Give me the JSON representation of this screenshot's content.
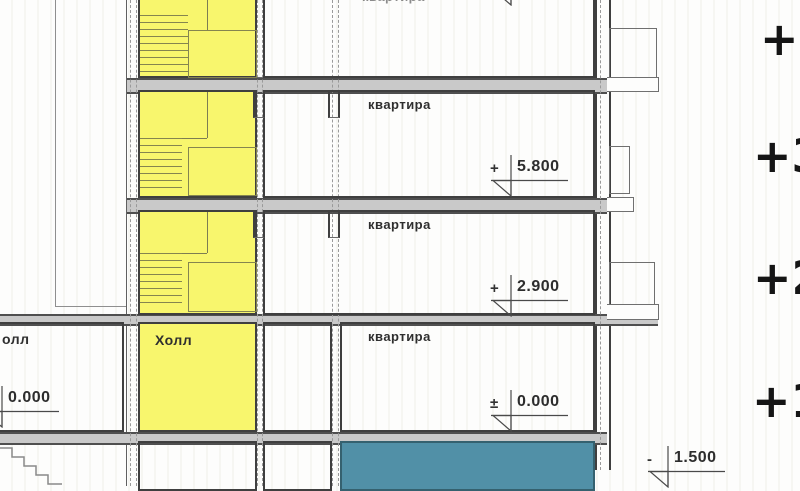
{
  "rooms": {
    "hall": "Холл",
    "hall_left_cut": "олл"
  },
  "floors": {
    "top": {
      "label": "квартира"
    },
    "third": {
      "label": "квартира",
      "elev_sign": "+",
      "elev_value": "5.800"
    },
    "second": {
      "label": "квартира",
      "elev_sign": "+",
      "elev_value": "2.900"
    },
    "first": {
      "label": "квартира",
      "elev_sign": "±",
      "elev_value": "0.000"
    }
  },
  "left_wing": {
    "elev_value": "0.000"
  },
  "basement": {
    "elev_sign": "-",
    "elev_value": "1.500"
  },
  "story_markers": {
    "s4": "+4",
    "s3": "+3",
    "s2": "+2",
    "s1": "+1"
  },
  "colors": {
    "stair_yellow": "#f8f66d",
    "pool_teal": "#5190a7",
    "slab_gray": "#c9c9c9",
    "wall_dark": "#3f3f3f"
  }
}
